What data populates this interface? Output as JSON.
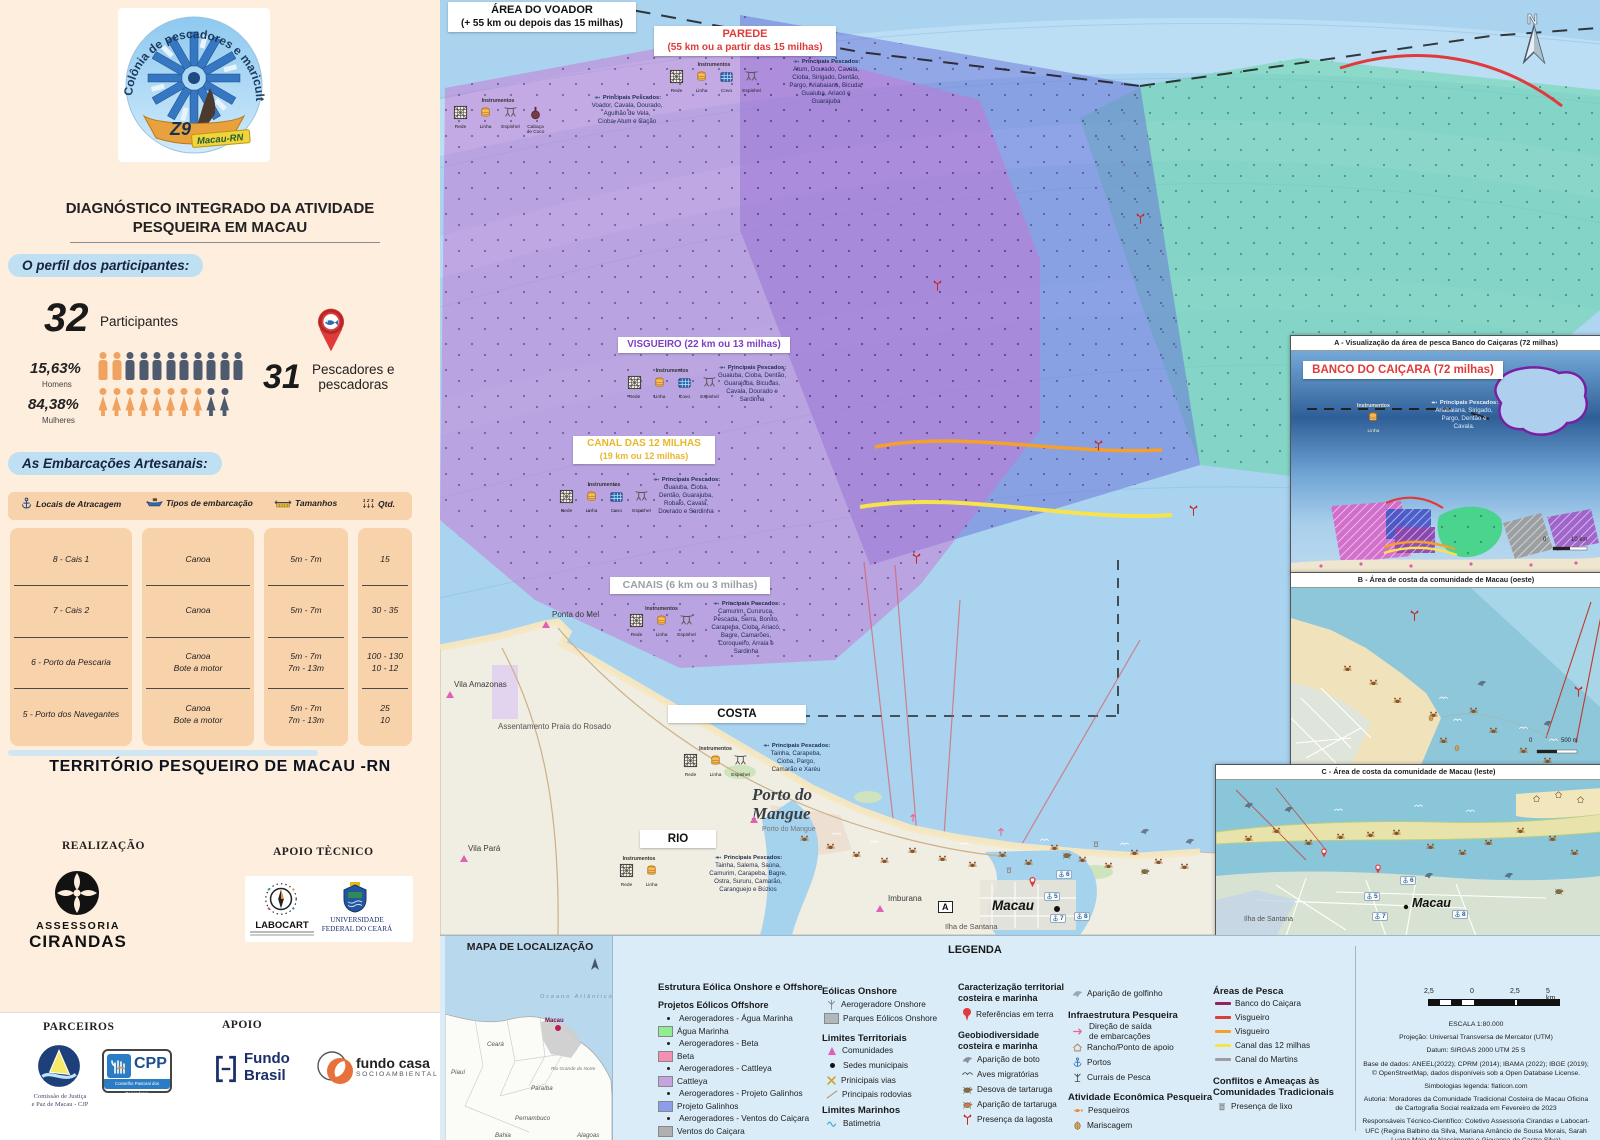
{
  "sidebar": {
    "logo": {
      "arc": "Colônia de pescadores e maricultura",
      "z9": "Z9",
      "city": "Macau-RN"
    },
    "title": "DIAGNÓSTICO INTEGRADO DA ATIVIDADE\nPESQUEIRA EM MACAU",
    "profile": {
      "heading": "O perfil dos participantes:",
      "participants_value": "32",
      "participants_label": "Participantes",
      "men_pct": "15,63%",
      "men_label": "Homens",
      "women_pct": "84,38%",
      "women_label": "Mulheres",
      "fishers_value": "31",
      "fishers_label": "Pescadores e\npescadoras"
    },
    "boats": {
      "heading": "As Embarcações Artesanais:",
      "columns": [
        {
          "label": "Locais de Atracagem"
        },
        {
          "label": "Tipos de embarcação"
        },
        {
          "label": "Tamanhos"
        },
        {
          "label": "Qtd."
        }
      ],
      "rows": [
        {
          "local": "8 - Cais 1",
          "tipo": "Canoa",
          "tamanho": "5m - 7m",
          "qtd": "15"
        },
        {
          "local": "7 - Cais 2",
          "tipo": "Canoa",
          "tamanho": "5m - 7m",
          "qtd": "30 - 35"
        },
        {
          "local": "6 - Porto da Pescaria",
          "tipo": "Canoa\nBote a motor",
          "tamanho": "5m - 7m\n7m - 13m",
          "qtd": "100 - 130\n10 - 12"
        },
        {
          "local": "5 - Porto dos Navegantes",
          "tipo": "Canoa\nBote a motor",
          "tamanho": "5m - 7m\n7m - 13m",
          "qtd": "25\n10"
        }
      ]
    },
    "territory_title": "TERRITÓRIO PESQUEIRO DE MACAU -RN",
    "realizacao": {
      "label": "REALIZAÇÃO",
      "org_line1": "ASSESSORIA",
      "org_line2": "CIRANDAS"
    },
    "apoio_tecnico": {
      "label": "APOIO TÈCNICO",
      "labocart": "LABOCART",
      "ufc": "UNIVERSIDADE\nFEDERAL DO CEARÁ"
    },
    "parceiros": {
      "label": "PARCEIROS",
      "cjp_caption": "Comissão de Justiça\ne Paz de Macau - CJP",
      "cpp": "CPP",
      "cpp_caption": "Conselho Pastoral dos Pescadores"
    },
    "apoio": {
      "label": "APOIO",
      "fundo_brasil": "Fundo\nBrasil",
      "fundo_casa": "fundo casa",
      "fundo_casa_sub": "SOCIOAMBIENTAL"
    }
  },
  "map": {
    "compass": "N",
    "ports": [
      "5",
      "6",
      "7",
      "8"
    ],
    "zones": {
      "voador": {
        "title": "ÁREA DO VOADOR",
        "subtitle": "(+ 55 km ou depois das 15 milhas)",
        "instr": "Instrumentos",
        "instruments": [
          "Rede",
          "Linha",
          "Espinhel",
          "Cabaça\nde Coco"
        ],
        "pescados_label": "Principais Pescados:",
        "pescados": "Voador, Cavala, Dourado,\nAgulhão de Vela,\nCioba, Atum e Cação"
      },
      "parede": {
        "title": "PAREDE",
        "subtitle": "(55 km ou a partir das 15 milhas)",
        "instr": "Instrumentos",
        "instruments": [
          "Rede",
          "Linha",
          "Covo",
          "Espinhel"
        ],
        "pescados_label": "Principais Pescados:",
        "pescados": "Atum, Dourado, Cavala,\nCioba, Sirigado, Dentão,\nPargo, Ariabaiana, Bicuda,\nGuaiuba, Ariacó e\nGuarajuba"
      },
      "visgueiro": {
        "title": "VISGUEIRO (22 km ou 13 milhas)",
        "instr": "Instrumentos",
        "instruments": [
          "Rede",
          "Linha",
          "Covo",
          "Espinhel"
        ],
        "pescados_label": "Principais Pescados:",
        "pescados": "Guaiuba, Cioba, Dentão,\nGuarajuba, Bicudas,\nCavala, Dourado e\nSardinha"
      },
      "canal12": {
        "title": "CANAL DAS 12 MILHAS",
        "subtitle": "(19 km ou 12 milhas)",
        "instr": "Instrumentos",
        "instruments": [
          "Rede",
          "Linha",
          "Covo",
          "Espinhel"
        ],
        "pescados_label": "Principais Pescados:",
        "pescados": "Guaiuba, Cioba,\nDentão, Guarajuba,\nRobalo, Cavala,\nDourado e Sardinha"
      },
      "canais": {
        "title": "CANAIS (6 km ou 3 milhas)",
        "instr": "Instrumentos",
        "instruments": [
          "Rede",
          "Linha",
          "Espinhel"
        ],
        "pescados_label": "Principais Pescados:",
        "pescados": "Camurim, Cururuca,\nPescada, Serra, Bonito,\nCarapeba, Cioba, Ariacó,\nBagre, Camarões,\nCoroqueiro, Arraia e\nSardinha"
      },
      "costa": {
        "title": "COSTA",
        "instr": "Instrumentos",
        "instruments": [
          "Rede",
          "Linha",
          "Espinhel"
        ],
        "pescados_label": "Principais Pescados:",
        "pescados": "Tainha, Carapeba,\nCioba, Pargo,\nCamarão e Xaréu"
      },
      "rio": {
        "title": "RIO",
        "instr": "Instrumentos",
        "instruments": [
          "Rede",
          "Linha"
        ],
        "pescados_label": "Principais Pescados:",
        "pescados": "Tainha, Salema, Saúna,\nCamurim, Carapeba, Bagre,\nOstra, Sururu, Camarão,\nCaranguejo e Búzios"
      }
    },
    "places": {
      "ponta_do_mel": "Ponta do Mel",
      "rosado": "Assentamento Praia do Rosado",
      "vila_amazonas": "Vila Amazonas",
      "vila_para": "Vila Pará",
      "porto_do_mangue": "Porto do\nMangue",
      "porto_do_mangue_small": "Porto do Mangue",
      "imburana": "Imburana",
      "macau": "Macau",
      "ilha_de_santana": "Ilha de Santana",
      "marker_a": "A"
    }
  },
  "insets": {
    "a": {
      "header": "A - Visualização da área de pesca Banco do Caiçaras (72 milhas)",
      "label": "BANCO DO CAIÇARA (72 milhas)",
      "instr": "Instrumentos",
      "instrument": "Linha",
      "pescados_label": "Principais Pescados:",
      "pescados": "Ariabaiana, Sirigado,\nPargo, Dentão e\nCavala.",
      "scale0": "0",
      "scale1": "10 km"
    },
    "b": {
      "header": "B - Área de costa da comunidade de Macau (oeste)",
      "scale0": "0",
      "scale1": "500 m"
    },
    "c": {
      "header": "C - Área de costa da comunidade de Macau (leste)",
      "macau": "Macau",
      "ilha": "Ilha de Santana"
    }
  },
  "bottom": {
    "location": {
      "title": "MAPA DE LOCALIZAÇÃO",
      "ocean": "Oceano Atlântico",
      "states": [
        "Ceará",
        "Piauí",
        "Paraíba",
        "Pernambuco",
        "Bahia",
        "Alagoas"
      ],
      "rn": "Rio Grande\ndo Norte",
      "macau": "Macau"
    },
    "legend": {
      "title": "LEGENDA",
      "offshore": {
        "header": "Estrutura Eólica Onshore e Offshore",
        "subheader": "Projetos Eólicos Offshore",
        "items": [
          {
            "type": "dot",
            "label": "Aerogeradores - Água Marinha"
          },
          {
            "type": "swatch",
            "color": "#90ee90",
            "label": "Água Marinha"
          },
          {
            "type": "dot",
            "label": "Aerogeradores - Beta"
          },
          {
            "type": "swatch",
            "color": "#f48fb1",
            "label": "Beta"
          },
          {
            "type": "dot",
            "label": "Aerogeradores - Cattleya"
          },
          {
            "type": "swatch",
            "color": "#c5a3e0",
            "label": "Cattleya"
          },
          {
            "type": "dot",
            "label": "Aerogeradores - Projeto Galinhos"
          },
          {
            "type": "swatch",
            "color": "#8c9eea",
            "label": "Projeto Galinhos"
          },
          {
            "type": "dot",
            "label": "Aerogeradores - Ventos do Caiçara"
          },
          {
            "type": "swatch",
            "color": "#b0b0b0",
            "label": "Ventos do Caiçara"
          }
        ]
      },
      "onshore": {
        "header": "Eólicas Onshore",
        "items": [
          "Aerogeradore Onshore",
          "Parques Eólicos Onshore"
        ],
        "swatch_color": "#b0b8bd"
      },
      "limites_terr": {
        "header": "Limites Territoriais",
        "items": [
          "Comunidades",
          "Sedes municipais",
          "Prinicipais vias",
          "Principais rodovias"
        ]
      },
      "limites_mar": {
        "header": "Limites Marinhos",
        "items": [
          "Batimetria"
        ]
      },
      "caract": {
        "header": "Caracterização territorial\ncosteira e marinha",
        "items": [
          "Referências em terra"
        ]
      },
      "geobio": {
        "header": "Geobiodiversidade\ncosteira e marinha",
        "items": [
          "Aparição de boto",
          "Aves migratórias",
          "Desova de tartaruga",
          "Aparição de tartaruga",
          "Presença da lagosta",
          "Aparição de golfinho"
        ]
      },
      "infra": {
        "header": "Infraestrutura Pesqueira",
        "items": [
          "Direção de saída\nde embarcações",
          "Rancho/Ponto de apoio",
          "Portos",
          "Currais de Pesca"
        ]
      },
      "atividade": {
        "header": "Atividade Econômica Pesqueira",
        "items": [
          "Pesqueiros",
          "Mariscagem"
        ]
      },
      "areas": {
        "header": "Áreas de Pesca",
        "items": [
          {
            "color": "#8e2466",
            "label": "Banco do Caiçara"
          },
          {
            "color": "#e03a3a",
            "label": "Visgueiro"
          },
          {
            "color": "#f59f2c",
            "label": "Visgueiro"
          },
          {
            "color": "#f7e34b",
            "label": "Canal das 12 milhas"
          },
          {
            "color": "#9e9e9e",
            "label": "Canal do Martins"
          }
        ]
      },
      "conflitos": {
        "header": "Conflitos e Ameaças às\nComunidades Tradicionais",
        "items": [
          "Presença de lixo"
        ]
      }
    },
    "credits": {
      "scale_labels": [
        "2,5",
        "0",
        "2,5",
        "5 km"
      ],
      "lines": [
        "ESCALA 1:80.000",
        "Projeção: Universal Transversa de Mercator (UTM)",
        "Datum: SIRGAS 2000 UTM 25 S",
        "Base de dados: ANEEL(2022); CPRM (2014); IBAMA (2022); IBGE (2019); © OpenStreetMap, dados disponíveis sob a Open Database License.",
        "Simbologias legenda: flaticon.com",
        "Autoria: Moradores da Comunidade Tradicional Costeira de Macau Oficina de Cartografia Social realizada em Fevereiro de 2023",
        "Responsáveis Técnico-Científico: Coletivo Assessoria Cirandas e Labocart-UFC (Regina Balbino da Silva, Mariana Amâncio de Sousa Morais, Sarah Luana Maia do Nascimento e Giovanna de Castro Silva)"
      ]
    }
  }
}
